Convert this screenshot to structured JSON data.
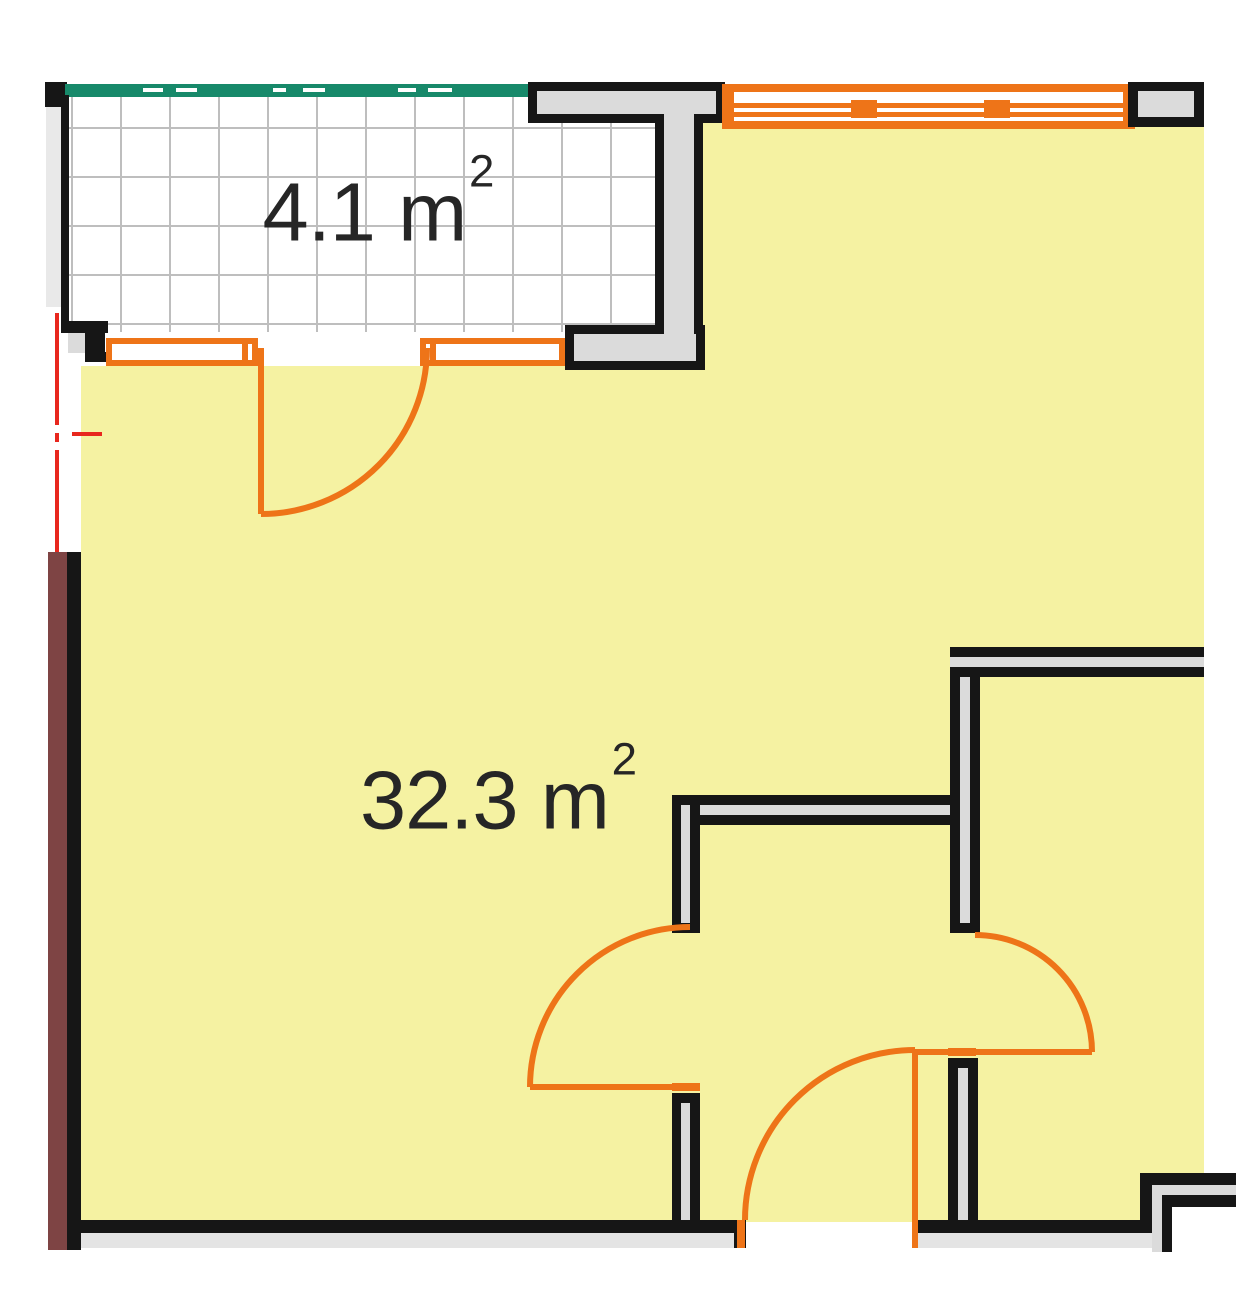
{
  "labels": {
    "balcony": {
      "value": "4.1",
      "unit": "m",
      "sup": "2"
    },
    "room": {
      "value": "32.3",
      "unit": "m",
      "sup": "2"
    }
  },
  "colors": {
    "white": "#FFFFFF",
    "yellow": "#F5F2A2",
    "orange": "#EE7418",
    "teal": "#17896A",
    "maroon": "#7E4444",
    "wall": "#DBDBDB",
    "apron": "#E4E4E4",
    "strip": "#E9E9E9",
    "grid": "#BEBEBE",
    "black": "#161616",
    "red": "#E8271E",
    "text": "#262626"
  },
  "shapes": [
    {
      "t": "rect",
      "n": "living-room-floor",
      "x": 81,
      "y": 366,
      "w": 624,
      "h": 856,
      "f": "yellow"
    },
    {
      "t": "rect",
      "n": "right-rooms-floor",
      "x": 703,
      "y": 123,
      "w": 501,
      "h": 1099,
      "f": "yellow"
    },
    {
      "t": "rect",
      "n": "balcony-floor",
      "x": 68,
      "y": 97,
      "w": 589,
      "h": 235,
      "f": "white"
    },
    {
      "t": "grid",
      "n": "balcony-floor-grid",
      "x": 68,
      "y": 97,
      "w": 589,
      "h": 235,
      "gx": 72,
      "gy": 128,
      "p": 49,
      "nv": 12,
      "nh": 5,
      "f": "grid"
    },
    {
      "t": "rect",
      "n": "corner-wall-block",
      "x": 45,
      "y": 82,
      "w": 22,
      "h": 25,
      "f": "black"
    },
    {
      "t": "rect",
      "n": "balcony-railing",
      "x": 65,
      "y": 84,
      "w": 463,
      "h": 13,
      "f": "teal"
    },
    {
      "t": "rect",
      "n": "railing-dash-1",
      "x": 143,
      "y": 88,
      "w": 20,
      "h": 4,
      "f": "white"
    },
    {
      "t": "rect",
      "n": "railing-dash-2",
      "x": 176,
      "y": 88,
      "w": 21,
      "h": 4,
      "f": "white"
    },
    {
      "t": "rect",
      "n": "railing-dash-3",
      "x": 273,
      "y": 88,
      "w": 13,
      "h": 4,
      "f": "white"
    },
    {
      "t": "rect",
      "n": "railing-dash-4",
      "x": 303,
      "y": 88,
      "w": 22,
      "h": 4,
      "f": "white"
    },
    {
      "t": "rect",
      "n": "railing-dash-5",
      "x": 398,
      "y": 88,
      "w": 18,
      "h": 4,
      "f": "white"
    },
    {
      "t": "rect",
      "n": "railing-dash-6",
      "x": 428,
      "y": 88,
      "w": 24,
      "h": 4,
      "f": "white"
    },
    {
      "t": "rect",
      "n": "left-facade-strip",
      "x": 46,
      "y": 107,
      "w": 15,
      "h": 200,
      "f": "strip"
    },
    {
      "t": "rect",
      "n": "balcony-left-wall-line",
      "x": 61,
      "y": 95,
      "w": 8,
      "h": 238,
      "f": "black"
    },
    {
      "t": "rect",
      "n": "balcony-step-top",
      "x": 63,
      "y": 321,
      "w": 45,
      "h": 12,
      "f": "black"
    },
    {
      "t": "rect",
      "n": "balcony-step-pocket",
      "x": 68,
      "y": 333,
      "w": 17,
      "h": 20,
      "f": "wall"
    },
    {
      "t": "rect",
      "n": "balcony-step-block",
      "x": 85,
      "y": 333,
      "w": 20,
      "h": 29,
      "f": "black"
    },
    {
      "t": "rect",
      "n": "balcony-step-bottom",
      "x": 85,
      "y": 352,
      "w": 42,
      "h": 10,
      "f": "black"
    },
    {
      "t": "rect",
      "n": "pier-slab-outline",
      "x": 528,
      "y": 82,
      "w": 197,
      "h": 41,
      "f": "black"
    },
    {
      "t": "rect",
      "n": "pier-stem-outline",
      "x": 655,
      "y": 114,
      "w": 48,
      "h": 256,
      "f": "black"
    },
    {
      "t": "rect",
      "n": "pier-step-outline",
      "x": 565,
      "y": 325,
      "w": 140,
      "h": 45,
      "f": "black"
    },
    {
      "t": "rect",
      "n": "pier-slab-fill",
      "x": 537,
      "y": 91,
      "w": 179,
      "h": 23,
      "f": "wall"
    },
    {
      "t": "rect",
      "n": "pier-stem-fill",
      "x": 664,
      "y": 91,
      "w": 30,
      "h": 270,
      "f": "wall"
    },
    {
      "t": "rect",
      "n": "pier-step-fill",
      "x": 574,
      "y": 334,
      "w": 122,
      "h": 27,
      "f": "wall"
    },
    {
      "t": "rect",
      "n": "balcony-window-left-glass",
      "x": 106,
      "y": 338,
      "w": 152,
      "h": 28,
      "f": "white"
    },
    {
      "t": "rect",
      "n": "balcony-window-left-top-rail",
      "x": 106,
      "y": 338,
      "w": 152,
      "h": 6,
      "f": "orange"
    },
    {
      "t": "rect",
      "n": "balcony-window-left-bottom-rail",
      "x": 106,
      "y": 360,
      "w": 152,
      "h": 6,
      "f": "orange"
    },
    {
      "t": "rect",
      "n": "balcony-window-left-cap-l",
      "x": 106,
      "y": 338,
      "w": 6,
      "h": 28,
      "f": "orange"
    },
    {
      "t": "rect",
      "n": "balcony-window-left-cap-r",
      "x": 252,
      "y": 338,
      "w": 6,
      "h": 28,
      "f": "orange"
    },
    {
      "t": "rect",
      "n": "balcony-window-left-divider",
      "x": 242,
      "y": 338,
      "w": 6,
      "h": 28,
      "f": "orange"
    },
    {
      "t": "rect",
      "n": "balcony-window-right-glass",
      "x": 420,
      "y": 338,
      "w": 145,
      "h": 28,
      "f": "white"
    },
    {
      "t": "rect",
      "n": "balcony-window-right-top-rail",
      "x": 420,
      "y": 338,
      "w": 145,
      "h": 6,
      "f": "orange"
    },
    {
      "t": "rect",
      "n": "balcony-window-right-bottom-rail",
      "x": 420,
      "y": 360,
      "w": 145,
      "h": 6,
      "f": "orange"
    },
    {
      "t": "rect",
      "n": "balcony-window-right-cap-l",
      "x": 420,
      "y": 338,
      "w": 6,
      "h": 28,
      "f": "orange"
    },
    {
      "t": "rect",
      "n": "balcony-window-right-cap-r",
      "x": 559,
      "y": 338,
      "w": 6,
      "h": 28,
      "f": "orange"
    },
    {
      "t": "rect",
      "n": "balcony-window-right-divider",
      "x": 430,
      "y": 338,
      "w": 6,
      "h": 28,
      "f": "orange"
    },
    {
      "t": "rect",
      "n": "top-window-glass",
      "x": 722,
      "y": 84,
      "w": 413,
      "h": 45,
      "f": "white"
    },
    {
      "t": "rect",
      "n": "top-window-top-rail",
      "x": 722,
      "y": 84,
      "w": 413,
      "h": 8,
      "f": "orange"
    },
    {
      "t": "rect",
      "n": "top-window-mid-rail-a",
      "x": 722,
      "y": 103,
      "w": 413,
      "h": 5,
      "f": "orange"
    },
    {
      "t": "rect",
      "n": "top-window-mid-rail-b",
      "x": 722,
      "y": 112,
      "w": 413,
      "h": 5,
      "f": "orange"
    },
    {
      "t": "rect",
      "n": "top-window-bottom-rail",
      "x": 722,
      "y": 121,
      "w": 413,
      "h": 8,
      "f": "orange"
    },
    {
      "t": "rect",
      "n": "top-window-cap-l",
      "x": 722,
      "y": 84,
      "w": 12,
      "h": 45,
      "f": "orange"
    },
    {
      "t": "rect",
      "n": "top-window-cap-r",
      "x": 1123,
      "y": 84,
      "w": 12,
      "h": 45,
      "f": "orange"
    },
    {
      "t": "rect",
      "n": "top-window-mullion-1",
      "x": 851,
      "y": 100,
      "w": 26,
      "h": 18,
      "f": "orange"
    },
    {
      "t": "rect",
      "n": "top-window-mullion-2",
      "x": 984,
      "y": 100,
      "w": 26,
      "h": 18,
      "f": "orange"
    },
    {
      "t": "rect",
      "n": "top-right-wall-outline",
      "x": 1128,
      "y": 82,
      "w": 76,
      "h": 45,
      "f": "black"
    },
    {
      "t": "rect",
      "n": "top-right-wall-fill",
      "x": 1138,
      "y": 91,
      "w": 56,
      "h": 26,
      "f": "wall"
    },
    {
      "t": "rect",
      "n": "partition-v-upper-edge-l",
      "x": 950,
      "y": 647,
      "w": 10,
      "h": 286,
      "f": "black"
    },
    {
      "t": "rect",
      "n": "partition-v-upper-core",
      "x": 960,
      "y": 647,
      "w": 10,
      "h": 276,
      "f": "wall"
    },
    {
      "t": "rect",
      "n": "partition-v-upper-edge-r",
      "x": 970,
      "y": 647,
      "w": 10,
      "h": 286,
      "f": "black"
    },
    {
      "t": "rect",
      "n": "partition-v-upper-cap",
      "x": 950,
      "y": 923,
      "w": 30,
      "h": 10,
      "f": "black"
    },
    {
      "t": "rect",
      "n": "partition-h-right-edge-t",
      "x": 950,
      "y": 647,
      "w": 254,
      "h": 10,
      "f": "black"
    },
    {
      "t": "rect",
      "n": "partition-h-right-core",
      "x": 950,
      "y": 657,
      "w": 254,
      "h": 10,
      "f": "wall"
    },
    {
      "t": "rect",
      "n": "partition-h-right-edge-b",
      "x": 950,
      "y": 667,
      "w": 254,
      "h": 10,
      "f": "black"
    },
    {
      "t": "rect",
      "n": "partition-v-lower-cap",
      "x": 948,
      "y": 1058,
      "w": 30,
      "h": 10,
      "f": "black"
    },
    {
      "t": "rect",
      "n": "partition-v-lower-edge-l",
      "x": 948,
      "y": 1058,
      "w": 10,
      "h": 162,
      "f": "black"
    },
    {
      "t": "rect",
      "n": "partition-v-lower-core",
      "x": 958,
      "y": 1068,
      "w": 10,
      "h": 152,
      "f": "wall"
    },
    {
      "t": "rect",
      "n": "partition-v-lower-edge-r",
      "x": 968,
      "y": 1058,
      "w": 10,
      "h": 162,
      "f": "black"
    },
    {
      "t": "rect",
      "n": "partition-h-center-edge-t",
      "x": 672,
      "y": 795,
      "w": 278,
      "h": 10,
      "f": "black"
    },
    {
      "t": "rect",
      "n": "partition-h-center-core",
      "x": 680,
      "y": 805,
      "w": 270,
      "h": 10,
      "f": "wall"
    },
    {
      "t": "rect",
      "n": "partition-h-center-edge-b",
      "x": 672,
      "y": 815,
      "w": 278,
      "h": 10,
      "f": "black"
    },
    {
      "t": "rect",
      "n": "partition-h-center-cap",
      "x": 672,
      "y": 795,
      "w": 8,
      "h": 30,
      "f": "black"
    },
    {
      "t": "rect",
      "n": "stub-upper-edge-l",
      "x": 672,
      "y": 795,
      "w": 9,
      "h": 138,
      "f": "black"
    },
    {
      "t": "rect",
      "n": "stub-upper-core",
      "x": 681,
      "y": 805,
      "w": 10,
      "h": 118,
      "f": "wall"
    },
    {
      "t": "rect",
      "n": "stub-upper-edge-r",
      "x": 690,
      "y": 795,
      "w": 10,
      "h": 138,
      "f": "black"
    },
    {
      "t": "rect",
      "n": "stub-upper-cap",
      "x": 672,
      "y": 923,
      "w": 28,
      "h": 10,
      "f": "black"
    },
    {
      "t": "rect",
      "n": "stub-lower-cap",
      "x": 672,
      "y": 1093,
      "w": 28,
      "h": 10,
      "f": "black"
    },
    {
      "t": "rect",
      "n": "stub-lower-edge-l",
      "x": 672,
      "y": 1093,
      "w": 9,
      "h": 127,
      "f": "black"
    },
    {
      "t": "rect",
      "n": "stub-lower-core",
      "x": 681,
      "y": 1103,
      "w": 10,
      "h": 117,
      "f": "wall"
    },
    {
      "t": "rect",
      "n": "stub-lower-edge-r",
      "x": 690,
      "y": 1093,
      "w": 10,
      "h": 127,
      "f": "black"
    },
    {
      "t": "rect",
      "n": "bottom-wall-left",
      "x": 81,
      "y": 1220,
      "w": 653,
      "h": 13,
      "f": "black"
    },
    {
      "t": "rect",
      "n": "bottom-wall-left-cap",
      "x": 734,
      "y": 1220,
      "w": 12,
      "h": 28,
      "f": "black"
    },
    {
      "t": "rect",
      "n": "bottom-wall-right",
      "x": 918,
      "y": 1220,
      "w": 230,
      "h": 13,
      "f": "black"
    },
    {
      "t": "rect",
      "n": "bottom-wall-right-cap",
      "x": 918,
      "y": 1220,
      "w": 22,
      "h": 28,
      "f": "black"
    },
    {
      "t": "rect",
      "n": "bottom-apron-left",
      "x": 81,
      "y": 1233,
      "w": 653,
      "h": 15,
      "f": "apron"
    },
    {
      "t": "rect",
      "n": "bottom-apron-right",
      "x": 918,
      "y": 1233,
      "w": 239,
      "h": 15,
      "f": "apron"
    },
    {
      "t": "rect",
      "n": "shaft-outer-wall-h",
      "x": 1140,
      "y": 1173,
      "w": 96,
      "h": 12,
      "f": "black"
    },
    {
      "t": "rect",
      "n": "shaft-outer-wall-v",
      "x": 1140,
      "y": 1173,
      "w": 12,
      "h": 60,
      "f": "black"
    },
    {
      "t": "rect",
      "n": "shaft-wall-fill-h",
      "x": 1152,
      "y": 1185,
      "w": 84,
      "h": 10,
      "f": "wall"
    },
    {
      "t": "rect",
      "n": "shaft-wall-fill-v",
      "x": 1152,
      "y": 1185,
      "w": 10,
      "h": 67,
      "f": "wall"
    },
    {
      "t": "rect",
      "n": "shaft-inner-wall-h",
      "x": 1162,
      "y": 1195,
      "w": 74,
      "h": 12,
      "f": "black"
    },
    {
      "t": "rect",
      "n": "shaft-inner-wall-v",
      "x": 1162,
      "y": 1195,
      "w": 10,
      "h": 57,
      "f": "black"
    },
    {
      "t": "rect",
      "n": "shaft-interior",
      "x": 1172,
      "y": 1207,
      "w": 64,
      "h": 48,
      "f": "white"
    },
    {
      "t": "rect",
      "n": "section-wall-maroon",
      "x": 48,
      "y": 552,
      "w": 19,
      "h": 698,
      "f": "maroon"
    },
    {
      "t": "rect",
      "n": "section-wall-edge",
      "x": 67,
      "y": 552,
      "w": 14,
      "h": 698,
      "f": "black"
    },
    {
      "t": "rect",
      "n": "section-line-dash-1",
      "x": 55,
      "y": 313,
      "w": 4,
      "h": 112,
      "f": "red"
    },
    {
      "t": "rect",
      "n": "section-line-dot",
      "x": 55,
      "y": 433,
      "w": 4,
      "h": 9,
      "f": "red"
    },
    {
      "t": "rect",
      "n": "section-line-dash-2",
      "x": 55,
      "y": 450,
      "w": 4,
      "h": 102,
      "f": "red"
    },
    {
      "t": "rect",
      "n": "section-line-tick",
      "x": 72,
      "y": 432,
      "w": 30,
      "h": 4,
      "f": "red"
    },
    {
      "t": "rect",
      "n": "left-door-hinge-tick",
      "x": 672,
      "y": 1083,
      "w": 28,
      "h": 8,
      "f": "orange"
    },
    {
      "t": "rect",
      "n": "bottom-door-strike-tick",
      "x": 737,
      "y": 1220,
      "w": 8,
      "h": 28,
      "f": "orange"
    },
    {
      "t": "rect",
      "n": "right-door-hinge-tick",
      "x": 948,
      "y": 1048,
      "w": 28,
      "h": 8,
      "f": "orange"
    },
    {
      "t": "path",
      "n": "balcony-door-leaf",
      "d": "M 261 348 L 261 514",
      "s": "orange",
      "w": 6
    },
    {
      "t": "path",
      "n": "balcony-door-swing",
      "d": "M 261 514 A 166 166 0 0 0 427 348",
      "s": "orange",
      "w": 6
    },
    {
      "t": "path",
      "n": "left-door-leaf",
      "d": "M 530 1087 L 700 1087",
      "s": "orange",
      "w": 6
    },
    {
      "t": "path",
      "n": "left-door-swing",
      "d": "M 530 1087 A 160 160 0 0 1 690 927",
      "s": "orange",
      "w": 6
    },
    {
      "t": "path",
      "n": "bottom-door-leaf",
      "d": "M 915 1050 L 915 1248",
      "s": "orange",
      "w": 6
    },
    {
      "t": "path",
      "n": "bottom-door-swing",
      "d": "M 745 1220 A 170 170 0 0 1 915 1050",
      "s": "orange",
      "w": 6
    },
    {
      "t": "path",
      "n": "right-door-leaf",
      "d": "M 915 1052 L 1092 1052",
      "s": "orange",
      "w": 6
    },
    {
      "t": "path",
      "n": "right-door-swing",
      "d": "M 975 935 A 117 117 0 0 1 1092 1052",
      "s": "orange",
      "w": 6
    }
  ]
}
